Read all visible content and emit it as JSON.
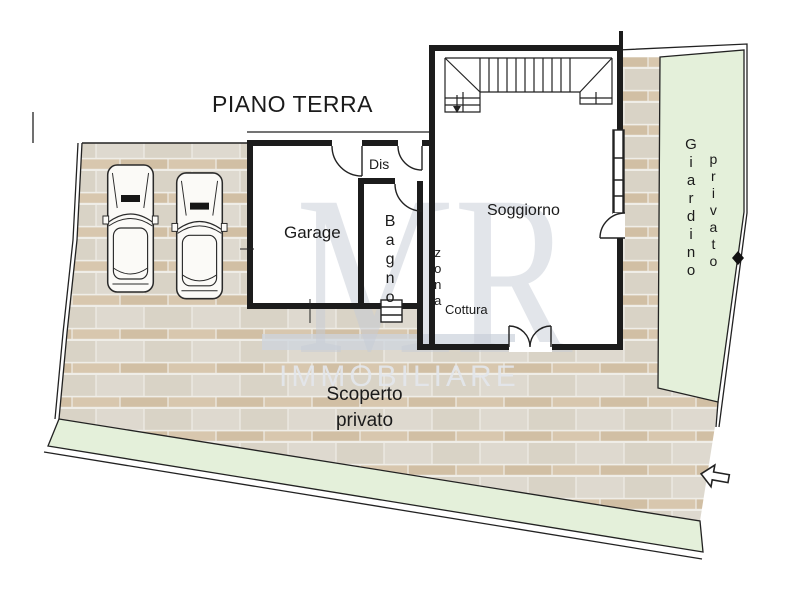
{
  "title": "PIANO TERRA",
  "watermark": {
    "monogram": "MR",
    "brand": "IMMOBILIARE"
  },
  "rooms": {
    "garage": "Garage",
    "dis": "Dis",
    "bagno": "Bagno",
    "zona": "zona",
    "cottura": "Cottura",
    "soggiorno": "Soggiorno"
  },
  "outdoor": {
    "giardino_word1": "Giardino",
    "giardino_word2": "privato",
    "scoperto_word1": "Scoperto",
    "scoperto_word2": "privato"
  },
  "icons": {
    "entrance_arrow": "⬅",
    "stairs_direction": "↓"
  },
  "colors": {
    "wall": "#1c1c1c",
    "line": "#222222",
    "garden_green": "#e4f0da",
    "paving_light": "#ded9cf",
    "paving_tan": "#d5c4ab",
    "watermark_gray": "#c6cbd5",
    "brand_band": "#cdd4dd",
    "brand_text": "#e3e6ec"
  }
}
